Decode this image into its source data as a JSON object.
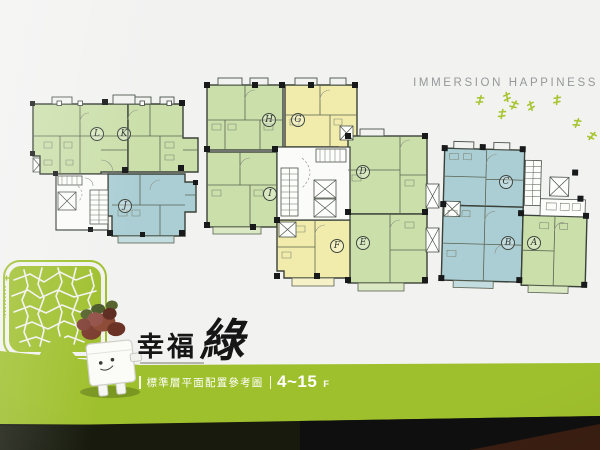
{
  "header": {
    "headline": "IMMERSION HAPPINESS"
  },
  "brand": {
    "title_prefix": "幸福",
    "title_script": "綠"
  },
  "footer": {
    "caption": "標準層平面配置參考圖",
    "floor_range": "4~15",
    "floor_suffix": "F"
  },
  "floorplan": {
    "units": [
      {
        "label": "A",
        "color_name": "green"
      },
      {
        "label": "B",
        "color_name": "blue"
      },
      {
        "label": "C",
        "color_name": "blue"
      },
      {
        "label": "D",
        "color_name": "green"
      },
      {
        "label": "E",
        "color_name": "green"
      },
      {
        "label": "F",
        "color_name": "yellow"
      },
      {
        "label": "G",
        "color_name": "yellow"
      },
      {
        "label": "H",
        "color_name": "green"
      },
      {
        "label": "I",
        "color_name": "green"
      },
      {
        "label": "J",
        "color_name": "blue"
      },
      {
        "label": "K",
        "color_name": "green"
      },
      {
        "label": "L",
        "color_name": "green"
      }
    ]
  },
  "colors": {
    "brand_green": "#9fc02d",
    "unit_green": "#cbdfaa",
    "unit_yellow": "#f2ecac",
    "unit_blue": "#abced5",
    "wall": "#3a4138",
    "headline_gray": "#95989a"
  },
  "decor": {
    "tree_icon": "mosaic-tree",
    "mascot": "robot-planter",
    "sprout_glyph_count": 8
  }
}
